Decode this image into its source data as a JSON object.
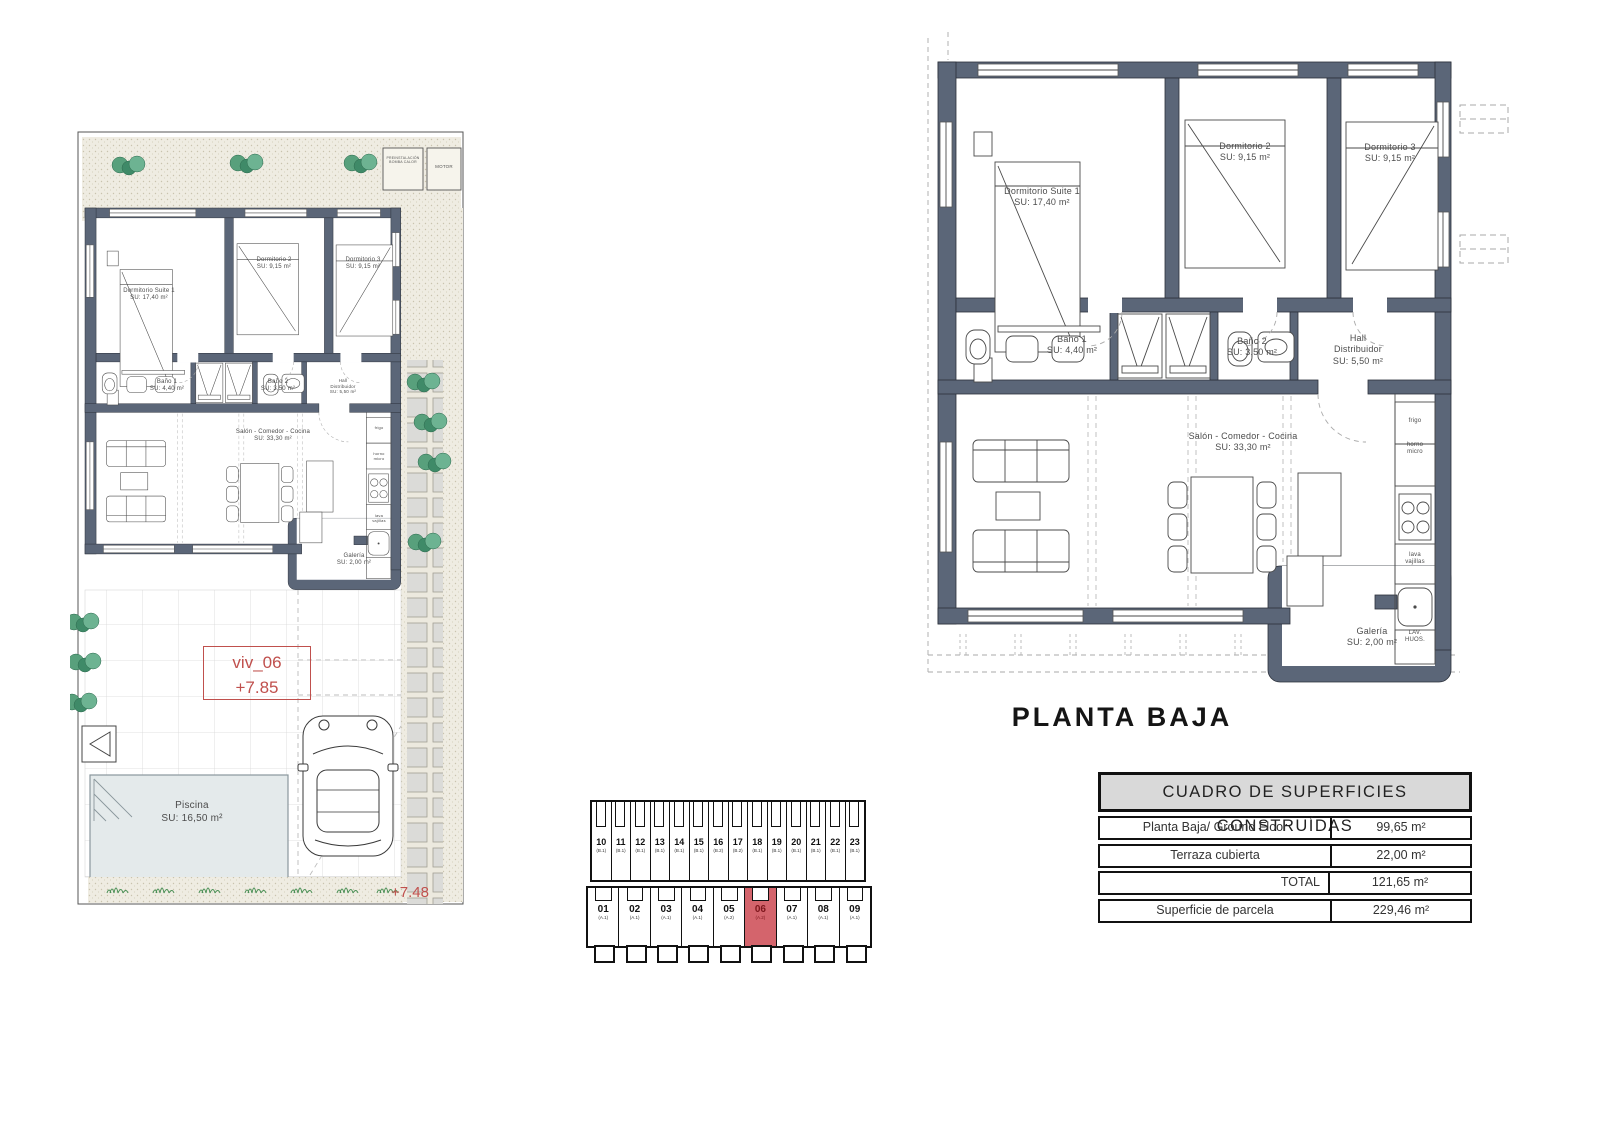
{
  "floor_plan": {
    "title": "PLANTA BAJA",
    "rooms": [
      {
        "name": "Dormitorio Suite 1",
        "area": "SU: 17,40 m²"
      },
      {
        "name": "Dormitorio 2",
        "area": "SU: 9,15 m²"
      },
      {
        "name": "Dormitorio 3",
        "area": "SU: 9,15 m²"
      },
      {
        "name": "Baño 1",
        "area": "SU: 4,40 m²"
      },
      {
        "name": "Baño 2",
        "area": "SU: 3,50 m²"
      },
      {
        "name": "Hall Distribuidor",
        "area": "SU: 5,50 m²"
      },
      {
        "name": "Salón - Comedor - Cocina",
        "area": "SU: 33,30 m²"
      },
      {
        "name": "Galería",
        "area": "SU: 2,00 m²"
      }
    ],
    "kitchen_labels": [
      "frigo",
      "horno micro",
      "lava vajillas",
      "LAV. HUOS."
    ]
  },
  "site_plan": {
    "unit_code": "viv_06",
    "unit_level": "+7.85",
    "entrance_level": "+7.48",
    "pool": {
      "name": "Piscina",
      "area": "SU: 16,50 m²"
    },
    "equipment": [
      "PREINSTALACIÓN BOMBA CALOR",
      "MOTOR"
    ]
  },
  "key_plan": {
    "highlighted": "06",
    "top_units": [
      {
        "number": "10",
        "type": "(B.1)"
      },
      {
        "number": "11",
        "type": "(B.1)"
      },
      {
        "number": "12",
        "type": "(B.1)"
      },
      {
        "number": "13",
        "type": "(B.1)"
      },
      {
        "number": "14",
        "type": "(B.1)"
      },
      {
        "number": "15",
        "type": "(B.1)"
      },
      {
        "number": "16",
        "type": "(B.2)"
      },
      {
        "number": "17",
        "type": "(B.2)"
      },
      {
        "number": "18",
        "type": "(B.1)"
      },
      {
        "number": "19",
        "type": "(B.1)"
      },
      {
        "number": "20",
        "type": "(B.1)"
      },
      {
        "number": "21",
        "type": "(B.1)"
      },
      {
        "number": "22",
        "type": "(B.1)"
      },
      {
        "number": "23",
        "type": "(B.1)"
      }
    ],
    "bottom_units": [
      {
        "number": "01",
        "type": "(A.1)"
      },
      {
        "number": "02",
        "type": "(A.1)"
      },
      {
        "number": "03",
        "type": "(A.1)"
      },
      {
        "number": "04",
        "type": "(A.1)"
      },
      {
        "number": "05",
        "type": "(A.2)"
      },
      {
        "number": "06",
        "type": "(A.2)"
      },
      {
        "number": "07",
        "type": "(A.1)"
      },
      {
        "number": "08",
        "type": "(A.1)"
      },
      {
        "number": "09",
        "type": "(A.1)"
      }
    ]
  },
  "areas_table": {
    "title": "CUADRO DE SUPERFICIES CONSTRUÍDAS",
    "rows": [
      {
        "label": "Planta Baja/ Ground Floor",
        "value": "99,65 m²"
      },
      {
        "label": "Terraza cubierta",
        "value": "22,00 m²"
      },
      {
        "label": "TOTAL",
        "value": "121,65 m²"
      },
      {
        "label": "Superficie de parcela",
        "value": "229,46 m²"
      }
    ]
  },
  "colors": {
    "wall": "#5b6678",
    "accent_red": "#c0504d",
    "highlight_unit": "#d4646c"
  }
}
